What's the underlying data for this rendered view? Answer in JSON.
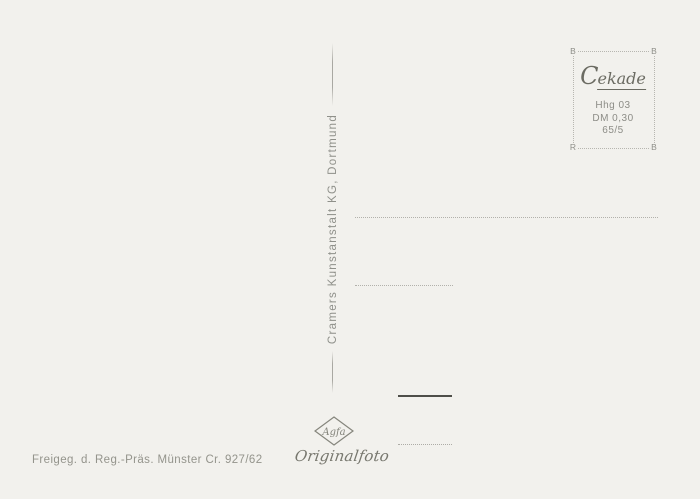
{
  "postcard": {
    "publisher_imprint": "Cramers Kunstanstalt KG, Dortmund",
    "stamp_box": {
      "brand_cap": "C",
      "brand_rest": "ekade",
      "info_lines": [
        "Hhg 03",
        "DM 0,30",
        "65/5"
      ],
      "corners": {
        "tl": "B",
        "tr": "B",
        "bl": "R",
        "br": "B"
      }
    },
    "photo_credit": {
      "logo_text": "Agfa",
      "script_text": "Originalfoto"
    },
    "censor_note": "Freigeg. d. Reg.-Präs. Münster Cr. 927/62",
    "colors": {
      "background": "#f2f1ed",
      "ink_gray": "#8f908a",
      "ink_dark": "#6b6b62",
      "dotted_line": "#b2b1ab",
      "solid_line": "#4e4e49"
    }
  }
}
